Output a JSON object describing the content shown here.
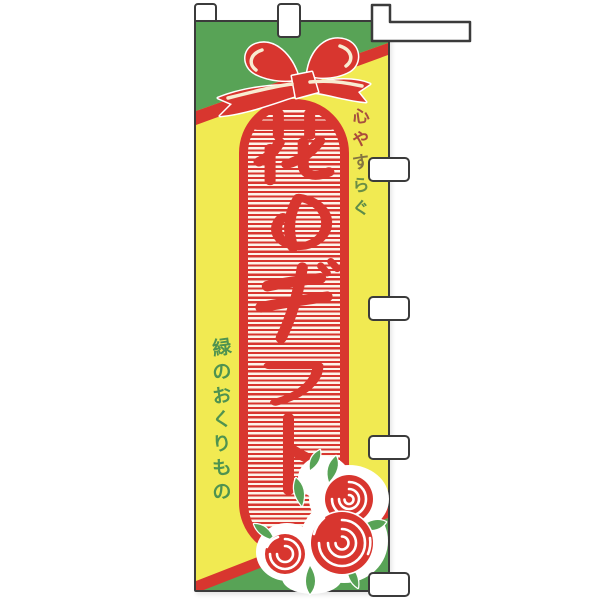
{
  "flag": {
    "title": {
      "text": "花のギフト",
      "chars": [
        "花",
        "の",
        "ギ",
        "フ",
        "ト"
      ],
      "color": "#d8362f"
    },
    "right_phrase": {
      "text": "心やすらぐ",
      "chars": [
        {
          "ch": "心",
          "color": "#a6503f"
        },
        {
          "ch": "や",
          "color": "#ab4b3b"
        },
        {
          "ch": "す",
          "color": "#837440"
        },
        {
          "ch": "ら",
          "color": "#6b8f45"
        },
        {
          "ch": "ぐ",
          "color": "#5d8c49"
        }
      ]
    },
    "left_phrase": {
      "text": "緑のおくりもの",
      "chars": [
        "緑",
        "の",
        "お",
        "く",
        "り",
        "も",
        "の"
      ],
      "color": "#4f9350"
    },
    "colors": {
      "yellow": "#f1ea52",
      "green": "#58a356",
      "red": "#d8362f",
      "stripe_cream": "#fdf4ea",
      "outline": "#3b3b3b",
      "tab_fill": "#ffffff"
    },
    "decorations": {
      "bow": "ribbon-bow-icon",
      "flowers": "rose-bouquet-icon"
    },
    "tabs": {
      "top_count": 3,
      "side_count": 4
    }
  }
}
